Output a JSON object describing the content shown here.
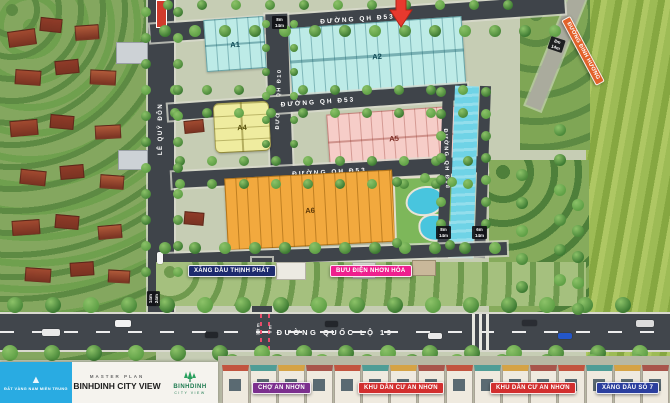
{
  "brand": {
    "left_logo_text": "ĐẤT VÀNG NAM MIỀN TRUNG",
    "master_plan_label": "MASTER PLAN",
    "project_name": "BINHDINH CITY VIEW",
    "right_logo_name": "BINHDINH",
    "right_logo_sub": "CITY VIEW"
  },
  "roads": {
    "qh_d53_top": "ĐƯỜNG QH Đ53",
    "qh_d53_mid": "ĐƯỜNG QH Đ53",
    "qh_d53_lower": "ĐƯỜNG QH Đ53",
    "le_quy_don": "LÊ QUÝ ĐÔN",
    "qh_d10": "ĐƯỜNG QH Đ10",
    "qh_d18": "ĐƯỜNG QH Đ18",
    "dinh_huong": "ĐƯỜNG ĐINH HƯƠNG",
    "quoc_lo_19": "ĐƯỜNG QUỐC LỘ 19"
  },
  "blocks": {
    "a1": "A1",
    "a2": "A2",
    "a4": "A4",
    "a5": "A5",
    "a6": "A6"
  },
  "badges": {
    "gas_thinh_phat": "XĂNG DẦU THỊNH PHÁT",
    "post_office": "BƯU ĐIỆN NHƠN HÒA",
    "market": "CHỢ AN NHƠN",
    "residential_left": "KHU DÂN CƯ AN NHƠN",
    "residential_right": "KHU DÂN CƯ AN NHƠN",
    "gas_station_7": "XĂNG DẦU SỐ 7"
  },
  "measurements": {
    "top_road_sign": "8m\n14m",
    "dinh_huong_sign": "8m\n14m",
    "canal_left_sign": "8m\n14m",
    "canal_right_sign": "6m\n14m",
    "le_quy_don_sign": "14m\n24m",
    "ql19_width": "30m",
    "ql19_lane": "6m"
  },
  "colors": {
    "badge_navy": "#1e2b6e",
    "badge_pink": "#ee1f8e",
    "badge_purple": "#7c2f8e",
    "badge_red": "#d22f2f",
    "badge_blue": "#2b3f9e",
    "arrow_red": "#e8392e",
    "canal_blue": "#6fd3e6",
    "block_teal": "#bdebe7",
    "block_yellow": "#efec9f",
    "block_pink": "#f6cdc8",
    "block_orange": "#f2a93e",
    "logo_blue": "#29abe2",
    "logo_green": "#1d7a4f"
  }
}
